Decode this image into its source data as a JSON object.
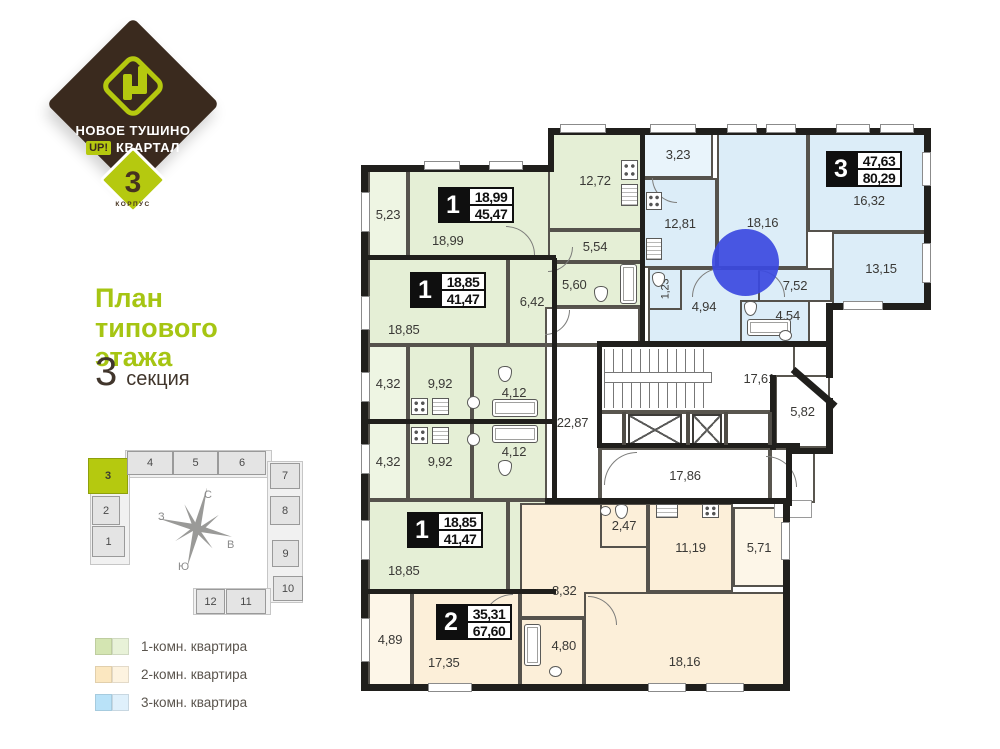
{
  "brand": {
    "line1": "НОВОЕ ТУШИНО",
    "up": "UP!",
    "line2": "КВАРТАЛ",
    "block_number": "3",
    "block_label": "КОРПУС"
  },
  "sidebar": {
    "title_l1": "План",
    "title_l2": "типового",
    "title_l3": "этажа",
    "section_number": "3",
    "section_label": "секция"
  },
  "minimap": {
    "sections": [
      "1",
      "2",
      "3",
      "4",
      "5",
      "6",
      "7",
      "8",
      "9",
      "10",
      "11",
      "12"
    ],
    "highlighted_section": "3",
    "compass": {
      "n": "С",
      "s": "Ю",
      "w": "З",
      "e": "В"
    }
  },
  "legend": {
    "items": [
      {
        "label": "1-комн. квартира",
        "color": "#d4e5b2",
        "color_light": "#e8f2d8"
      },
      {
        "label": "2-комн. квартира",
        "color": "#fbe7c0",
        "color_light": "#fdf3e0"
      },
      {
        "label": "3-комн. квартира",
        "color": "#b9e2f8",
        "color_light": "#dff0fb"
      }
    ]
  },
  "plan": {
    "apartments": {
      "a1": {
        "type": "1",
        "living": "18,99",
        "total": "45,47",
        "rooms": {
          "living": "18,99",
          "kitchen": "12,72",
          "hall": "5,54",
          "bath": "5,60",
          "balcony": "5,23"
        }
      },
      "b1": {
        "type": "1",
        "living": "18,85",
        "total": "41,47",
        "rooms": {
          "living": "18,85",
          "hall": "6,42",
          "kitchen": "9,92",
          "bath": "4,12",
          "balcony": "4,32"
        }
      },
      "b2": {
        "type": "1",
        "living": "18,85",
        "total": "41,47",
        "rooms": {
          "living": "18,85",
          "hall": "6,42",
          "kitchen": "9,92",
          "bath": "4,12",
          "balcony": "4,32"
        }
      },
      "c2": {
        "type": "2",
        "living": "35,31",
        "total": "67,60",
        "rooms": {
          "living1": "17,35",
          "living2": "18,16",
          "kitchen": "11,19",
          "hall": "8,32",
          "bath": "4,80",
          "wc": "2,47",
          "balcony1": "4,89",
          "balcony2": "5,71"
        }
      },
      "d3": {
        "type": "3",
        "living": "47,63",
        "total": "80,29",
        "rooms": {
          "balcony": "3,23",
          "kitchen": "12,81",
          "living1": "18,16",
          "living2": "16,32",
          "living3": "13,15",
          "hall1": "7,52",
          "hall2": "4,94",
          "wc": "1,23",
          "bath": "4,54"
        }
      }
    },
    "common": {
      "hall_left": "22,87",
      "stairs": "17,61",
      "corridor": "17,86",
      "entrance": "5,82"
    }
  },
  "colors": {
    "brand_brown": "#3a2a1e",
    "brand_green": "#b5c90f",
    "title_green": "#a6c513",
    "room_green": "#e5efd6",
    "room_blue": "#dcedf8",
    "room_orange": "#fcefd9",
    "wall_dark": "#201f1c",
    "marker_blue": "#3b49e0"
  }
}
